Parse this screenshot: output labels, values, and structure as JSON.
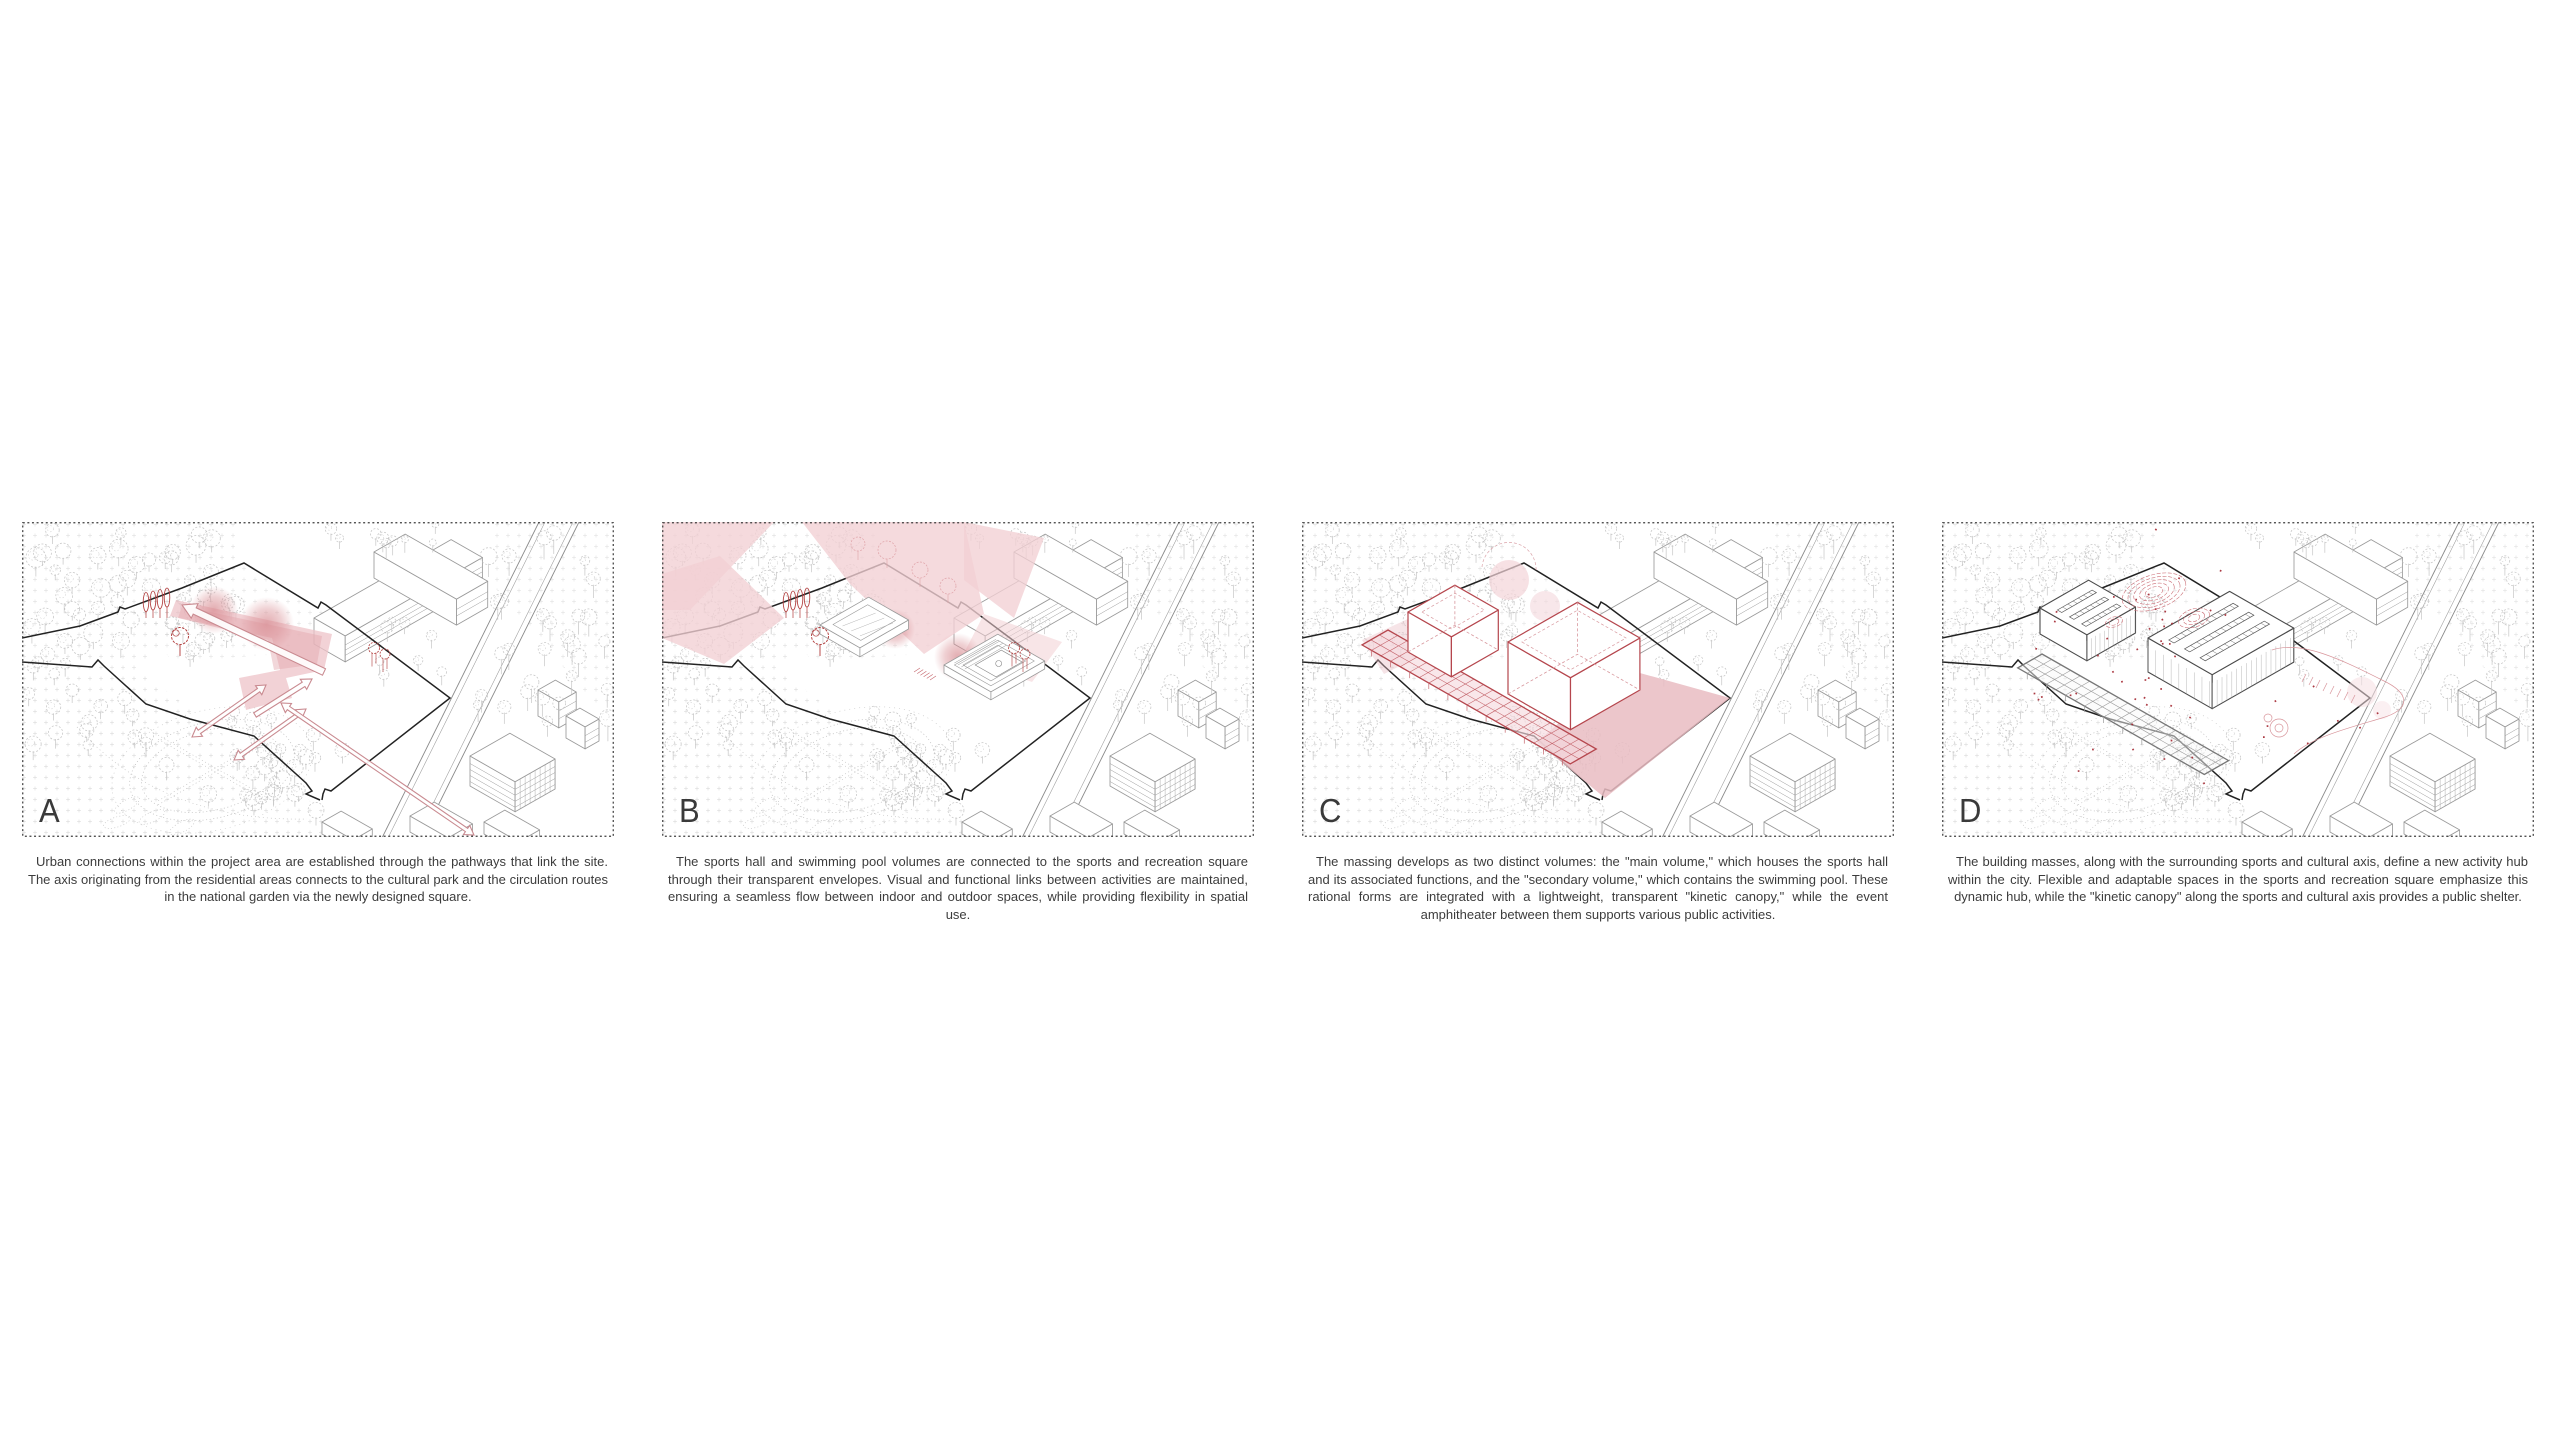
{
  "board": {
    "name": "concept-diagram-board"
  },
  "panels": [
    {
      "letter": "A",
      "caption": "Urban connections within the project area are established through the pathways that link the site. The axis originating from the residential areas connects to the cultural park and the circulation routes in the national garden via the newly designed square."
    },
    {
      "letter": "B",
      "caption": "The sports hall and swimming pool volumes are connected to the sports and recreation square through their transparent envelopes. Visual and functional links between activities are maintained, ensuring a seamless flow between indoor and outdoor spaces, while providing flexibility in spatial use."
    },
    {
      "letter": "C",
      "caption": "The massing develops as two distinct volumes: the \"main volume,\" which houses the sports hall and its associated functions, and the \"secondary volume,\" which contains the swimming pool. These rational forms are integrated with a lightweight, transparent \"kinetic canopy,\" while the event amphitheater between them supports various public activities."
    },
    {
      "letter": "D",
      "caption": "The building masses, along with the surrounding sports and cultural axis, define a new activity hub within the city. Flexible and adaptable spaces in the sports and recreation square emphasize this dynamic hub, while the \"kinetic canopy\" along the sports and cultural axis provides a public shelter."
    }
  ],
  "colors": {
    "wash_pink": "#f2cfd4",
    "band_pink": "#eec3c8",
    "band_inner_pink": "#e2a6ac",
    "plaza_pink": "#e9bcc2",
    "blob_pink": "#d98f95",
    "accent_red": "#b5464d",
    "canopy_red": "#c4656c",
    "sketch_red": "#cc7078",
    "arrow_red": "#c98a90",
    "dot_red": "#a2232e",
    "tree_red": "#b03a3a",
    "line_gray": "#c6c6c6",
    "building_gray": "#9a9a9a",
    "dark_building_gray": "#4a4a4a",
    "boundary_black": "#222222",
    "border_gray": "#3c3c3c"
  }
}
